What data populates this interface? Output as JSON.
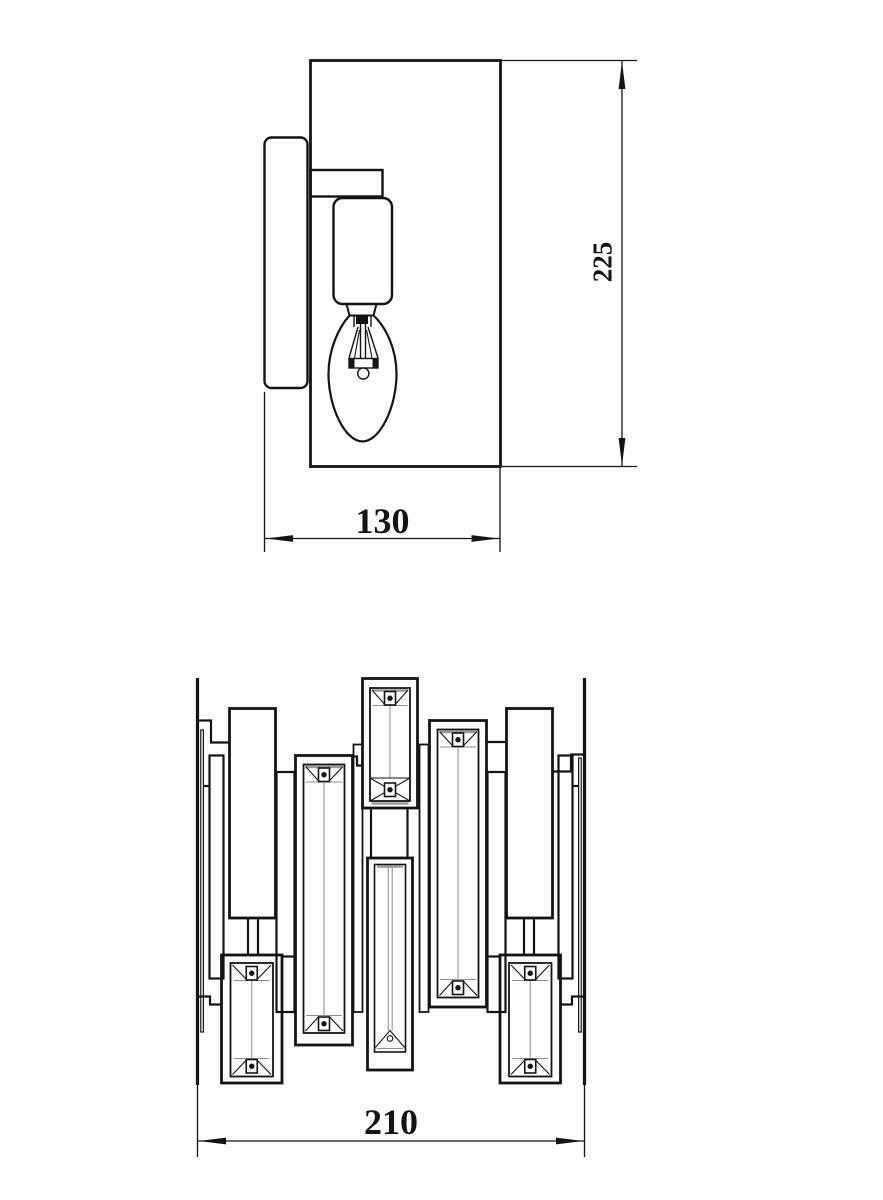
{
  "sheet": {
    "background": "#fdfdfd",
    "ink": "#141414",
    "bevel_gray": "#8f8f8f"
  },
  "side_view": {
    "height_dim": "225",
    "width_dim": "130"
  },
  "front_view": {
    "width_dim": "210"
  }
}
